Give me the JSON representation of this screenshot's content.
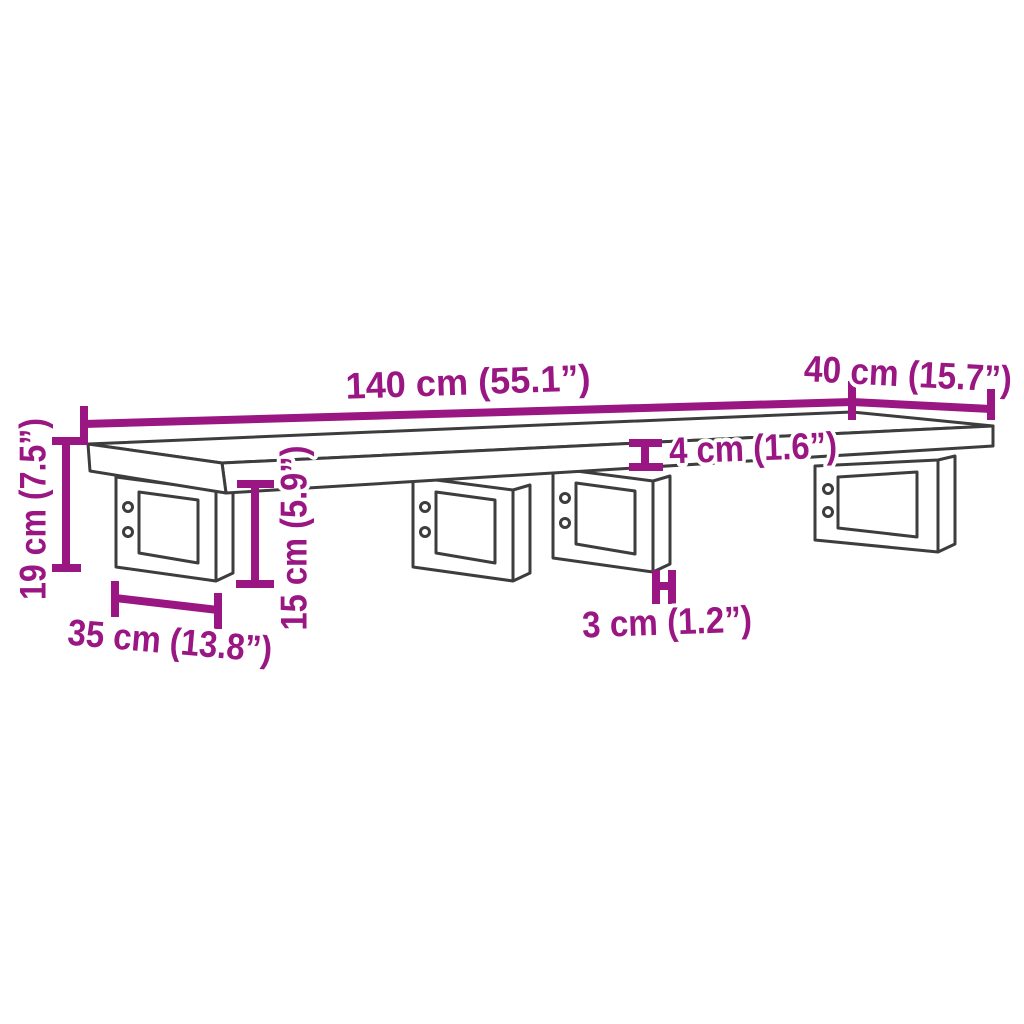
{
  "diagram": {
    "type": "product-dimension-diagram",
    "subject": "wall-mounted shelf with steel brackets",
    "background_color": "#ffffff",
    "outline_color": "#3d3d3d",
    "dimension_color": "#9A1683",
    "dimensions": {
      "shelf_length": {
        "value_cm": 140,
        "value_in": 55.1,
        "label": "140 cm (55.1”)"
      },
      "shelf_depth": {
        "value_cm": 40,
        "value_in": 15.7,
        "label": "40 cm (15.7”)"
      },
      "overall_height": {
        "value_cm": 19,
        "value_in": 7.5,
        "label": "19 cm (7.5”)"
      },
      "bracket_depth": {
        "value_cm": 35,
        "value_in": 13.8,
        "label": "35 cm (13.8”)"
      },
      "bracket_height": {
        "value_cm": 15,
        "value_in": 5.9,
        "label": "15 cm (5.9”)"
      },
      "shelf_thickness": {
        "value_cm": 4,
        "value_in": 1.6,
        "label": "4 cm (1.6”)"
      },
      "bracket_bar_thickness": {
        "value_cm": 3,
        "value_in": 1.2,
        "label": "3 cm (1.2”)"
      }
    }
  }
}
